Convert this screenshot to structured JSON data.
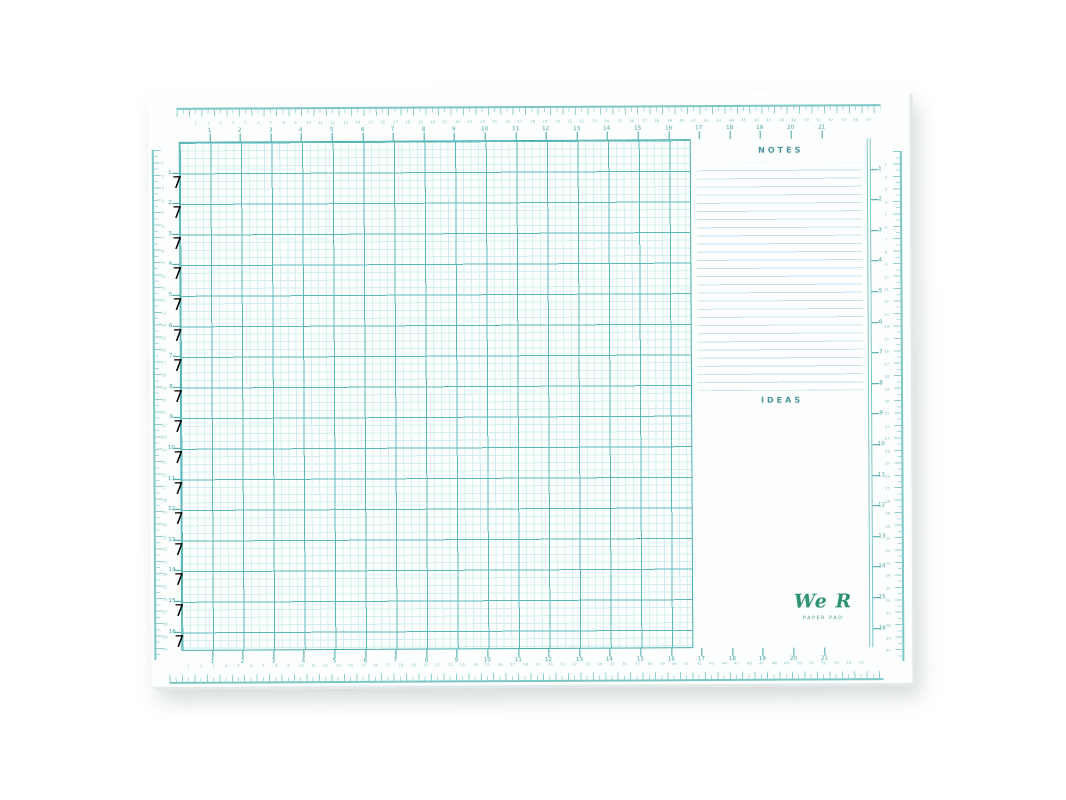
{
  "product": {
    "brand_script": "We R",
    "brand_sub": "PAPER PAD"
  },
  "panels": {
    "notes_title": "NOTES",
    "ideas_title": "IDEAS",
    "notes_line_count": 28,
    "notes_line_step_px": 8.15
  },
  "colors": {
    "teal_dark": "#3fa3a3",
    "teal_grid_major": "#5cb9b9",
    "teal_grid_minor": "#d3eeee",
    "teal_ruler": "#7cc6c6",
    "cm_number": "#86c5c5",
    "panel_title": "#48939b",
    "notes_line": "#c3e4ec",
    "logo_green": "#2f9371",
    "paper": "#fdfffe",
    "background": "#ffffff"
  },
  "grid": {
    "unit_px": 30.6,
    "minor_px": 7.65,
    "origin_x": 30,
    "origin_y": 48,
    "col_numbers": [
      1,
      2,
      3,
      4,
      5,
      6,
      7,
      8,
      9,
      10,
      11,
      12,
      13,
      14,
      15,
      16,
      17,
      18,
      19,
      20,
      21
    ],
    "row_numbers_left": [
      1,
      2,
      3,
      4,
      5,
      6,
      7,
      8,
      9,
      10,
      11,
      12,
      13,
      14,
      15,
      16
    ],
    "row_numbers_right": [
      1,
      2,
      3,
      4,
      5,
      6,
      7,
      8,
      9,
      10,
      11,
      12,
      13,
      14,
      15,
      16
    ],
    "col_num_y_top": 37,
    "col_tick_top_y": 40,
    "col_tick_top_h": 8,
    "col_num_y_bottom": 568,
    "col_tick_bottom_y": 557,
    "col_tick_bottom_h": 8,
    "row_num_x_left": 21,
    "row_tick_left_x": 23,
    "row_tick_left_w": 7,
    "row_num_x_right": 731,
    "row_tick_right_x": 722,
    "row_tick_right_w": 7
  },
  "edge_rulers": {
    "step_px": 12.45,
    "sides": [
      {
        "id": "top-edge-ruler",
        "axis": "x",
        "origin": 35,
        "num_coord": 30,
        "numbers": [
          1,
          2,
          3,
          4,
          5,
          6,
          7,
          8,
          9,
          10,
          11,
          12,
          13,
          14,
          15,
          16,
          17,
          18,
          19,
          20,
          21,
          22,
          23,
          24,
          25,
          26,
          27,
          28,
          29,
          30,
          31,
          32,
          33,
          34,
          35,
          36,
          37,
          38,
          39,
          40,
          41,
          42,
          43,
          44,
          45,
          46,
          47,
          48,
          49,
          50,
          51,
          52,
          53,
          54,
          55
        ]
      },
      {
        "id": "bottom-edge-ruler",
        "axis": "x",
        "origin": 25,
        "num_coord": 573,
        "numbers": [
          1,
          2,
          3,
          4,
          5,
          6,
          7,
          8,
          9,
          10,
          11,
          12,
          13,
          14,
          15,
          16,
          17,
          18,
          19,
          20,
          21,
          22,
          23,
          24,
          25,
          26,
          27,
          28,
          29,
          30,
          31,
          32,
          33,
          34,
          35,
          36,
          37,
          38,
          39,
          40,
          41,
          42,
          43,
          44,
          45,
          46,
          47,
          48,
          49,
          50,
          51,
          52,
          53,
          54,
          55
        ]
      },
      {
        "id": "left-edge-ruler",
        "axis": "y",
        "origin": 58,
        "num_coord": 14,
        "numbers": [
          1,
          2,
          3,
          4,
          5,
          6,
          7,
          8,
          9,
          10,
          11,
          12,
          13,
          14,
          15,
          16,
          17,
          18,
          19,
          20,
          21,
          22,
          23,
          24,
          25,
          26,
          27,
          28,
          29,
          30,
          31,
          32,
          33,
          34,
          35,
          36,
          37,
          38,
          39,
          40
        ]
      },
      {
        "id": "right-edge-ruler",
        "axis": "y",
        "origin": 63,
        "num_coord": 737,
        "numbers": [
          1,
          2,
          3,
          4,
          5,
          6,
          7,
          8,
          9,
          10,
          11,
          12,
          13,
          14,
          15,
          16,
          17,
          18,
          19,
          20,
          21,
          22,
          23,
          24,
          25,
          26,
          27,
          28,
          29,
          30,
          31,
          32,
          33,
          34,
          35,
          36,
          37,
          38,
          39,
          40
        ]
      }
    ]
  }
}
